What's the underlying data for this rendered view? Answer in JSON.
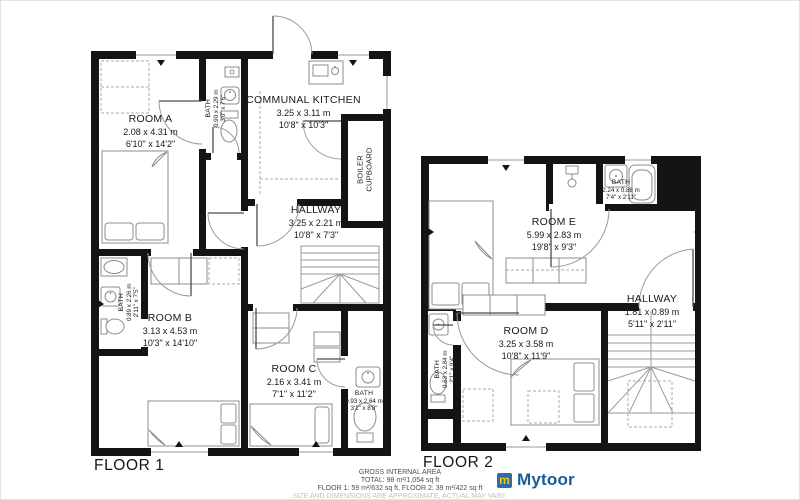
{
  "floor1": {
    "title": "FLOOR 1",
    "rooms": {
      "room_a": {
        "name": "ROOM A",
        "metric": "2.08 x 4.31 m",
        "imperial": "6'10\" x 14'2\""
      },
      "bath_a": {
        "name": "BATH",
        "metric": "0.90 x 2.29 m",
        "imperial": "3'0\" x 7'6\""
      },
      "kitchen": {
        "name": "COMMUNAL KITCHEN",
        "metric": "3.25 x 3.11 m",
        "imperial": "10'8\" x 10'3\""
      },
      "boiler": {
        "name": "BOILER CUPBOARD"
      },
      "hallway": {
        "name": "HALLWAY",
        "metric": "3.25 x 2.21 m",
        "imperial": "10'8\" x 7'3\""
      },
      "room_b": {
        "name": "ROOM B",
        "metric": "3.13 x 4.53 m",
        "imperial": "10'3\" x 14'10\""
      },
      "bath_b": {
        "name": "BATH",
        "metric": "0.89 x 2.26 m",
        "imperial": "2'11\" x 7'5\""
      },
      "room_c": {
        "name": "ROOM C",
        "metric": "2.16 x 3.41 m",
        "imperial": "7'1\" x 11'2\""
      },
      "bath_c": {
        "name": "BATH",
        "metric": "0.93 x 2.64 m",
        "imperial": "3'1\" x 8'8\""
      }
    }
  },
  "floor2": {
    "title": "FLOOR 2",
    "rooms": {
      "room_e": {
        "name": "ROOM E",
        "metric": "5.99 x 2.83 m",
        "imperial": "19'8\" x 9'3\""
      },
      "bath_e": {
        "name": "BATH",
        "metric": "2.24 x 0.88 m",
        "imperial": "7'4\" x 2'11\""
      },
      "hallway": {
        "name": "HALLWAY",
        "metric": "1.81 x 0.89 m",
        "imperial": "5'11\" x 2'11\""
      },
      "room_d": {
        "name": "ROOM D",
        "metric": "3.25 x 3.58 m",
        "imperial": "10'8\" x 11'9\""
      },
      "bath_d": {
        "name": "BATH",
        "metric": "0.63 x 2.84 m",
        "imperial": "2'1\" x 9'4\""
      }
    }
  },
  "footer": {
    "area_heading": "GROSS INTERNAL AREA",
    "area_total": "TOTAL: 98 m²/1,054 sq ft",
    "area_floors": "FLOOR 1: 59 m²/632 sq ft, FLOOR 2: 39 m²/422 sq ft",
    "disclaimer": "SIZE AND DIMENSIONS ARE APPROXIMATE, ACTUAL MAY VARY.",
    "brand_name": "Mytoor",
    "brand_icon_letter": "m",
    "brand_text_color": "#1b5b99",
    "brand_icon_bg": "#2d6ca8",
    "brand_icon_color": "#f2c218"
  }
}
